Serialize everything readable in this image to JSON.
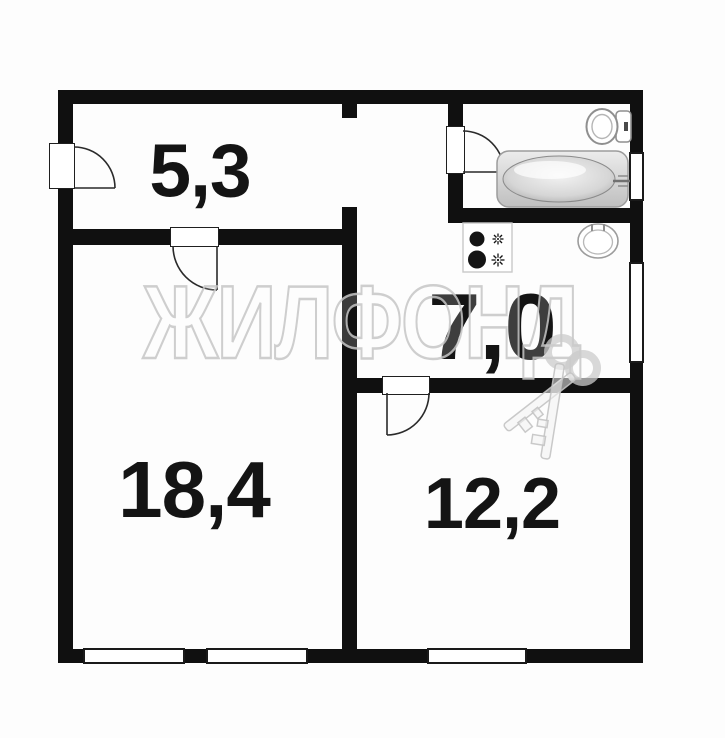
{
  "watermark": {
    "text": "ЖИЛФОНД"
  },
  "rooms": [
    {
      "name": "hallway",
      "area_label": "5,3"
    },
    {
      "name": "kitchen",
      "area_label": "7,0"
    },
    {
      "name": "living-room",
      "area_label": "18,4"
    },
    {
      "name": "bedroom",
      "area_label": "12,2"
    }
  ],
  "fixtures": [
    "bathtub-icon",
    "toilet-icon",
    "kitchen-sink-icon",
    "stove-icon",
    "keys-watermark-icon"
  ],
  "colors": {
    "wall": "#101010",
    "background": "#fdfdfd",
    "watermark_outline": "#c6c6c6",
    "fixture_outline": "#9a9a9a"
  }
}
